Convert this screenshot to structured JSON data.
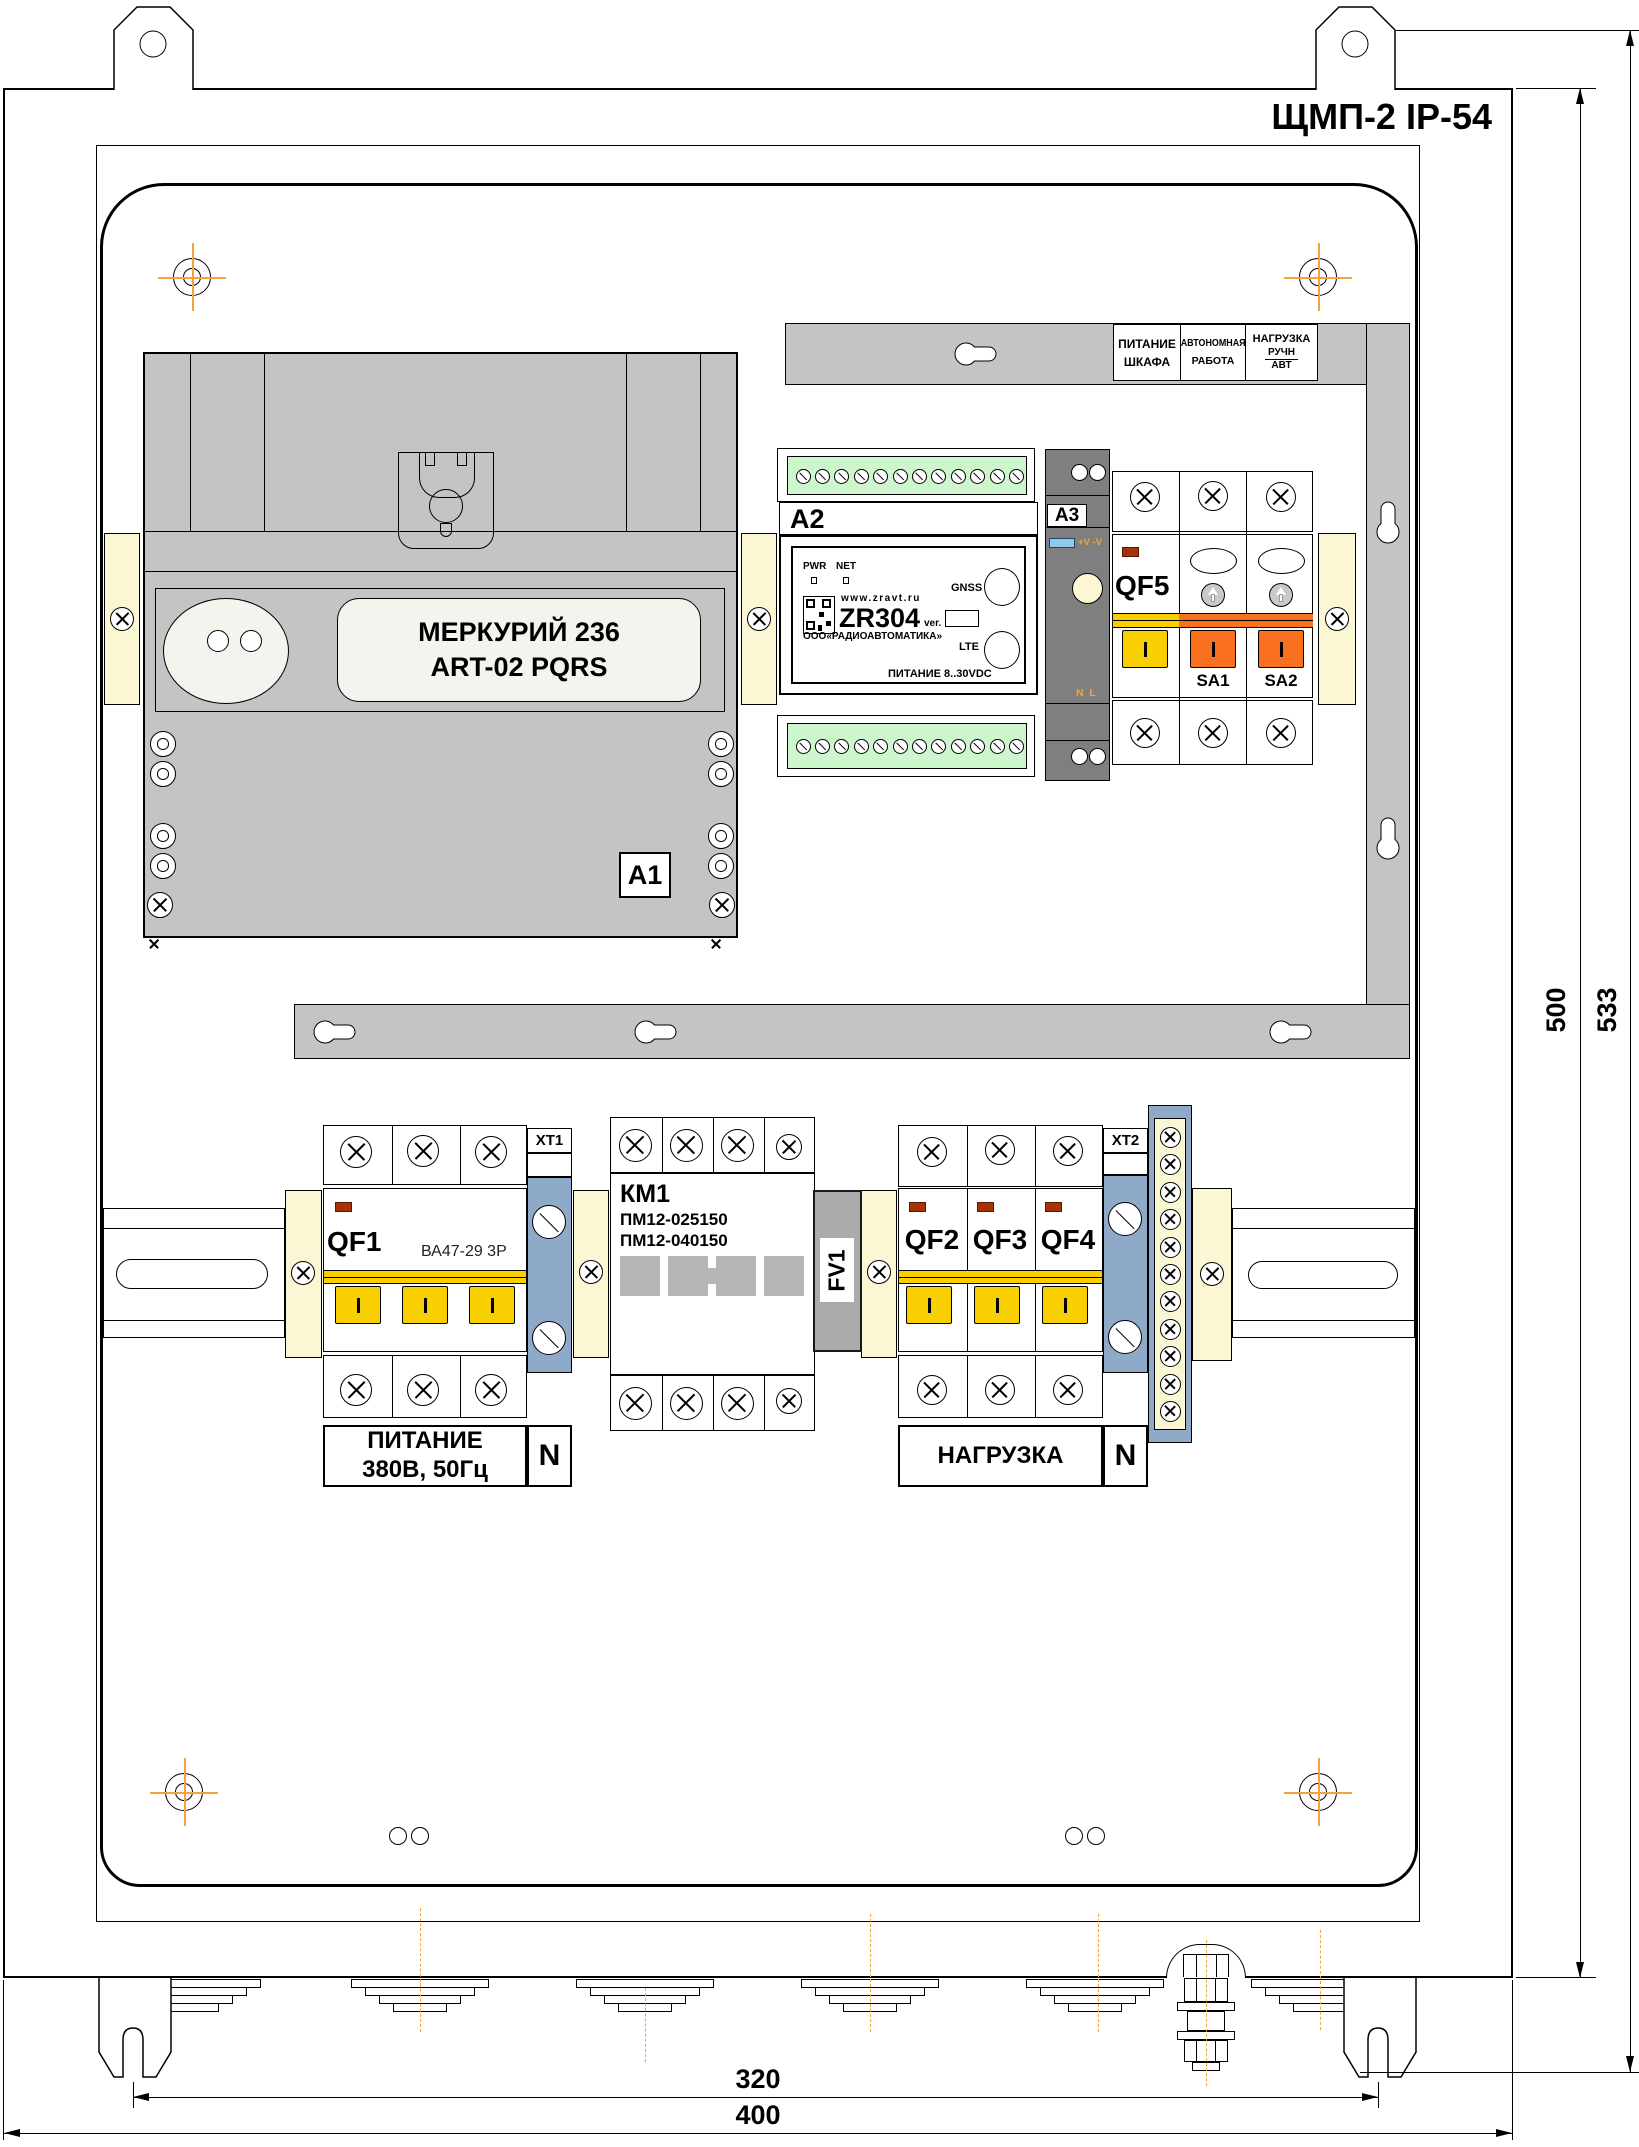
{
  "title": "ЩМП-2 IP-54",
  "indicator_panel": {
    "cell1_line1": "ПИТАНИЕ",
    "cell1_line2": "ШКАФА",
    "cell2_line1": "АВТОНОМНАЯ",
    "cell2_line2": "РАБОТА",
    "cell3_line1": "НАГРУЗКА",
    "cell3_top": "РУЧН",
    "cell3_bottom": "АВТ"
  },
  "meter": {
    "tag": "А1",
    "name_line1": "МЕРКУРИЙ 236",
    "name_line2": "ART-02 PQRS"
  },
  "controller": {
    "tag": "A2",
    "led1": "PWR",
    "led2": "NET",
    "url": "www.zravt.ru",
    "model": "ZR304",
    "ver_label": "ver.",
    "mfr": "ООО«РАДИОАВТОМАТИКА»",
    "port1": "GNSS",
    "port2": "LTE",
    "power": "ПИТАНИЕ 8..30VDC"
  },
  "psu": {
    "tag": "A3",
    "led_label": "+V -V",
    "terminals": "N  L"
  },
  "qf5": {
    "label": "QF5",
    "sa1": "SA1",
    "sa2": "SA2"
  },
  "input_breaker": {
    "label": "QF1",
    "type": "ВА47-29 3Р",
    "caption_line1": "ПИТАНИЕ",
    "caption_line2": "380В, 50Гц",
    "neutral": "N"
  },
  "terminal_blocks": {
    "xt1": "ХТ1",
    "xt2": "ХТ2"
  },
  "contactor": {
    "label": "КМ1",
    "type1": "ПМ12-025150",
    "type2": "ПМ12-040150"
  },
  "arrester": {
    "label": "FV1"
  },
  "load_breakers": {
    "items": [
      {
        "label": "QF2"
      },
      {
        "label": "QF3"
      },
      {
        "label": "QF4"
      }
    ],
    "caption": "НАГРУЗКА",
    "neutral": "N"
  },
  "dimensions": {
    "height_inner": "500",
    "height_outer": "533",
    "width_inner": "320",
    "width_outer": "400"
  }
}
